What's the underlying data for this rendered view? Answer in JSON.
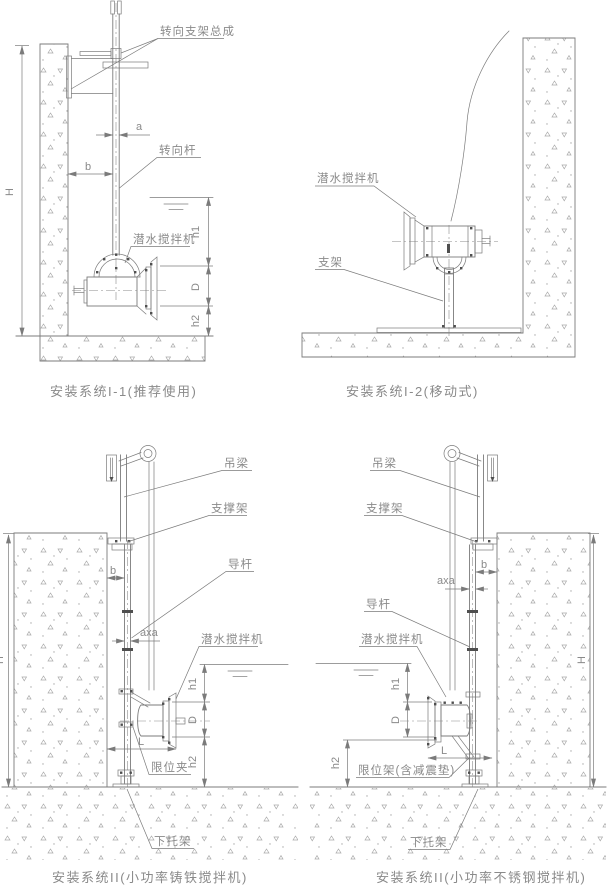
{
  "diagram": {
    "colors": {
      "line": "#7b7b7b",
      "text": "#8a8a8a",
      "stipple": "#a8a8a8",
      "background": "#ffffff"
    },
    "panels": {
      "i1": {
        "caption": "安装系统I-1(推荐使用)",
        "labels": {
          "steering_bracket_assembly": "转向支架总成",
          "steering_rod": "转向杆",
          "submersible_mixer": "潜水搅拌机"
        },
        "dims": {
          "a": "a",
          "b": "b",
          "H": "H",
          "h1": "h1",
          "D": "D",
          "h2": "h2"
        }
      },
      "i2": {
        "caption": "安装系统I-2(移动式)",
        "labels": {
          "submersible_mixer": "潜水搅拌机",
          "stand": "支架"
        }
      },
      "ii_cast_iron": {
        "caption": "安装系统II(小功率铸铁搅拌机)",
        "labels": {
          "hanging_beam": "吊梁",
          "support_frame": "支撑架",
          "guide_rod": "导杆",
          "submersible_mixer": "潜水搅拌机",
          "limit_clamp": "限位夹",
          "lower_bracket": "下托架"
        },
        "dims": {
          "b": "b",
          "axa": "axa",
          "H": "H",
          "h1": "h1",
          "D": "D",
          "h2": "h2",
          "L": "L"
        }
      },
      "ii_stainless": {
        "caption": "安装系统II(小功率不锈钢搅拌机)",
        "labels": {
          "hanging_beam": "吊梁",
          "support_frame": "支撑架",
          "guide_rod": "导杆",
          "submersible_mixer": "潜水搅拌机",
          "limit_frame": "限位架(含减震垫)",
          "lower_bracket": "下托架"
        },
        "dims": {
          "b": "b",
          "axa": "axa",
          "H": "H",
          "h1": "h1",
          "D": "D",
          "h2": "h2",
          "L": "L"
        }
      }
    }
  }
}
